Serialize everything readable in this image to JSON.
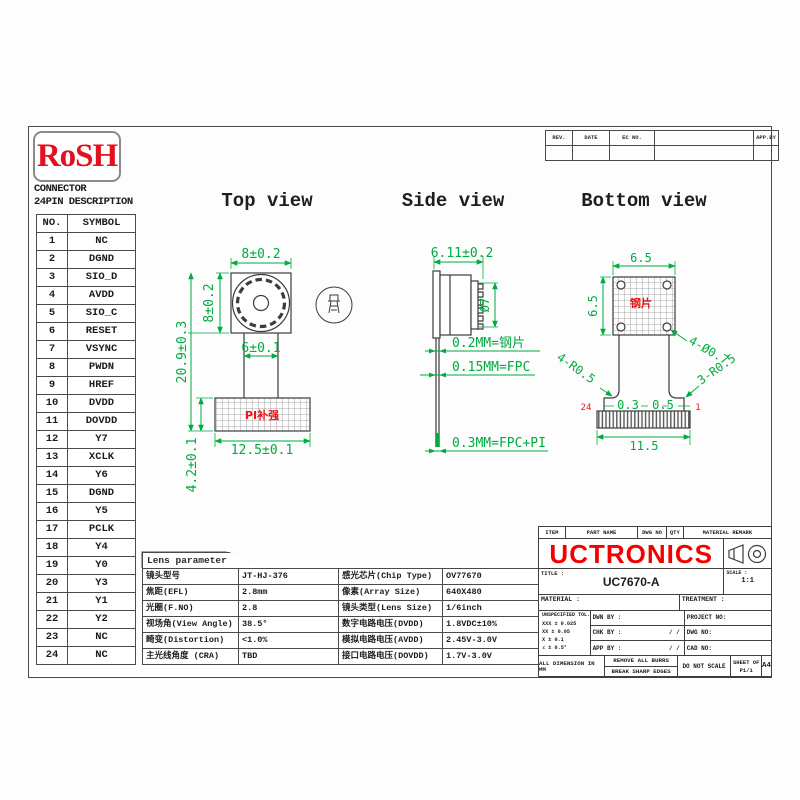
{
  "rosh": "RoSH",
  "connector": {
    "title1": "CONNECTOR",
    "title2": "24PIN DESCRIPTION",
    "header_no": "NO.",
    "header_symbol": "SYMBOL",
    "rows": [
      {
        "no": "1",
        "sym": "NC"
      },
      {
        "no": "2",
        "sym": "DGND"
      },
      {
        "no": "3",
        "sym": "SIO_D"
      },
      {
        "no": "4",
        "sym": "AVDD"
      },
      {
        "no": "5",
        "sym": "SIO_C"
      },
      {
        "no": "6",
        "sym": "RESET"
      },
      {
        "no": "7",
        "sym": "VSYNC"
      },
      {
        "no": "8",
        "sym": "PWDN"
      },
      {
        "no": "9",
        "sym": "HREF"
      },
      {
        "no": "10",
        "sym": "DVDD"
      },
      {
        "no": "11",
        "sym": "DOVDD"
      },
      {
        "no": "12",
        "sym": "Y7"
      },
      {
        "no": "13",
        "sym": "XCLK"
      },
      {
        "no": "14",
        "sym": "Y6"
      },
      {
        "no": "15",
        "sym": "DGND"
      },
      {
        "no": "16",
        "sym": "Y5"
      },
      {
        "no": "17",
        "sym": "PCLK"
      },
      {
        "no": "18",
        "sym": "Y4"
      },
      {
        "no": "19",
        "sym": "Y0"
      },
      {
        "no": "20",
        "sym": "Y3"
      },
      {
        "no": "21",
        "sym": "Y1"
      },
      {
        "no": "22",
        "sym": "Y2"
      },
      {
        "no": "23",
        "sym": "NC"
      },
      {
        "no": "24",
        "sym": "NC"
      }
    ]
  },
  "views": {
    "top": {
      "title": "Top view",
      "stiffener_label": "PI补强",
      "dims": {
        "width": "8±0.2",
        "height": "8±0.2",
        "total_height": "20.9±0.3",
        "fpc_width": "6±0.1",
        "stiffener_width": "12.5±0.1",
        "stiffener_height": "4.2±0.1"
      }
    },
    "side": {
      "title": "Side view",
      "dims": {
        "length": "6.11±0.2",
        "diameter": "Ø7"
      },
      "notes": {
        "steel": "0.2MM=钢片",
        "fpc": "0.15MM=FPC",
        "fpc_pi": "0.3MM=FPC+PI"
      }
    },
    "bottom": {
      "title": "Bottom view",
      "plate_label": "钢片",
      "pin_last": "24",
      "pin_first": "1",
      "dims": {
        "width": "6.5",
        "height": "6.5",
        "holes": "4-Ø0.7",
        "corner_left": "4-R0.5",
        "corner_right": "3-R0.5",
        "pitch_a": "0.3",
        "pitch_b": "0.5",
        "connector_width": "11.5"
      }
    }
  },
  "lens": {
    "tab": "Lens parameter",
    "rows": [
      {
        "c1": "镜头型号",
        "c2": "JT-HJ-376",
        "c3": "感光芯片(Chip Type)",
        "c4": "OV77670"
      },
      {
        "c1": "焦距(EFL)",
        "c2": "2.8mm",
        "c3": "像素(Array Size)",
        "c4": "640X480"
      },
      {
        "c1": "光圈(F.NO)",
        "c2": "2.8",
        "c3": "镜头类型(Lens Size)",
        "c4": "1/6inch"
      },
      {
        "c1": "视场角(View Angle)",
        "c2": "38.5°",
        "c3": "数字电路电压(DVDD)",
        "c4": "1.8VDC±10%"
      },
      {
        "c1": "畸变(Distortion)",
        "c2": "<1.0%",
        "c3": "模拟电路电压(AVDD)",
        "c4": "2.45V-3.0V"
      },
      {
        "c1": "主光线角度 (CRA)",
        "c2": "TBD",
        "c3": "接口电路电压(DOVDD)",
        "c4": "1.7V-3.0V"
      }
    ]
  },
  "rev": {
    "c1": "REV.",
    "c2": "DATE",
    "c3": "EC NO.",
    "c4": "",
    "c5": "APP.BY"
  },
  "tb": {
    "r1": [
      "ITEM",
      "PART NAME",
      "DWG NO",
      "QTY",
      "MATERIAL REMARK"
    ],
    "company": "UCTRONICS",
    "title_label": "TITLE :",
    "title": "UC7670-A",
    "scale_label": "SCALE :",
    "scale": "1:1",
    "material": "MATERIAL :",
    "treatment": "TREATMENT :",
    "tol_header": "UNSPECIFIED TOL.",
    "tol": [
      "XXX ± 0.025",
      "XX  ± 0.05",
      "X   ± 0.1",
      "∠   ± 0.5°"
    ],
    "dwn": "DWN BY :",
    "chk": "CHK BY :",
    "app": "APP BY :",
    "slash": "/    /",
    "project": "PROJECT NO:",
    "dwg": "DWG NO:",
    "cad": "CAD NO:",
    "alldim": "ALL DIMENSION IN MM",
    "burr1": "REMOVE ALL BURRS",
    "burr2": "BREAK SHARP EDGES",
    "noscale": "DO NOT SCALE",
    "sheet": "SHEET OF",
    "sheetno": "P1/1",
    "size": "A4"
  },
  "colors": {
    "accent_red": "#f40000",
    "dim_green": "#00ab3f",
    "line": "#3c3c3c"
  }
}
